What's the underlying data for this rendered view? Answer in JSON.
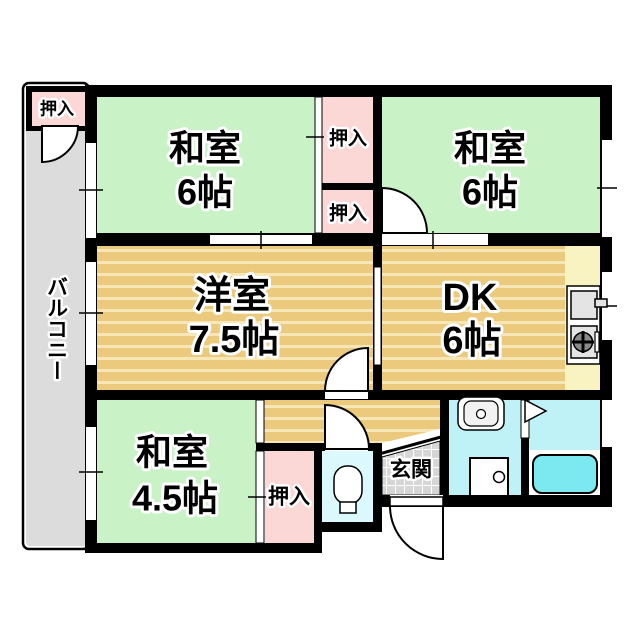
{
  "floorplan": {
    "title": "apartment-floor-plan",
    "rooms": {
      "washitsu_tl": {
        "name": "和室",
        "size": "6帖"
      },
      "washitsu_tr": {
        "name": "和室",
        "size": "6帖"
      },
      "youshitsu": {
        "name": "洋室",
        "size": "7.5帖"
      },
      "dk": {
        "name": "DK",
        "size": "6帖"
      },
      "washitsu_bl": {
        "name": "和室",
        "size": "4.5帖"
      },
      "balcony": {
        "name": "バルコニー"
      },
      "genkan": {
        "name": "玄関"
      },
      "closet_top_left": {
        "name": "押入"
      },
      "closet_mid_upper": {
        "name": "押入"
      },
      "closet_mid_lower": {
        "name": "押入"
      },
      "closet_bottom": {
        "name": "押入"
      }
    },
    "colors": {
      "wall": "#000000",
      "tatami_green": "#c9f2c6",
      "wood": "#ebc97d",
      "wood_stripe": "#f7e7b7",
      "closet_pink": "#fbd7d5",
      "balcony_gray": "#dcdcdc",
      "genkan_tile": "#d6d6d6",
      "toilet_room": "#dbf8fc",
      "bath_cyan": "#bff2f7",
      "tub_cyan": "#7ce9f0",
      "kitchen_yellow": "#f8f3c0",
      "fixture_gray": "#e4e4e4"
    }
  }
}
